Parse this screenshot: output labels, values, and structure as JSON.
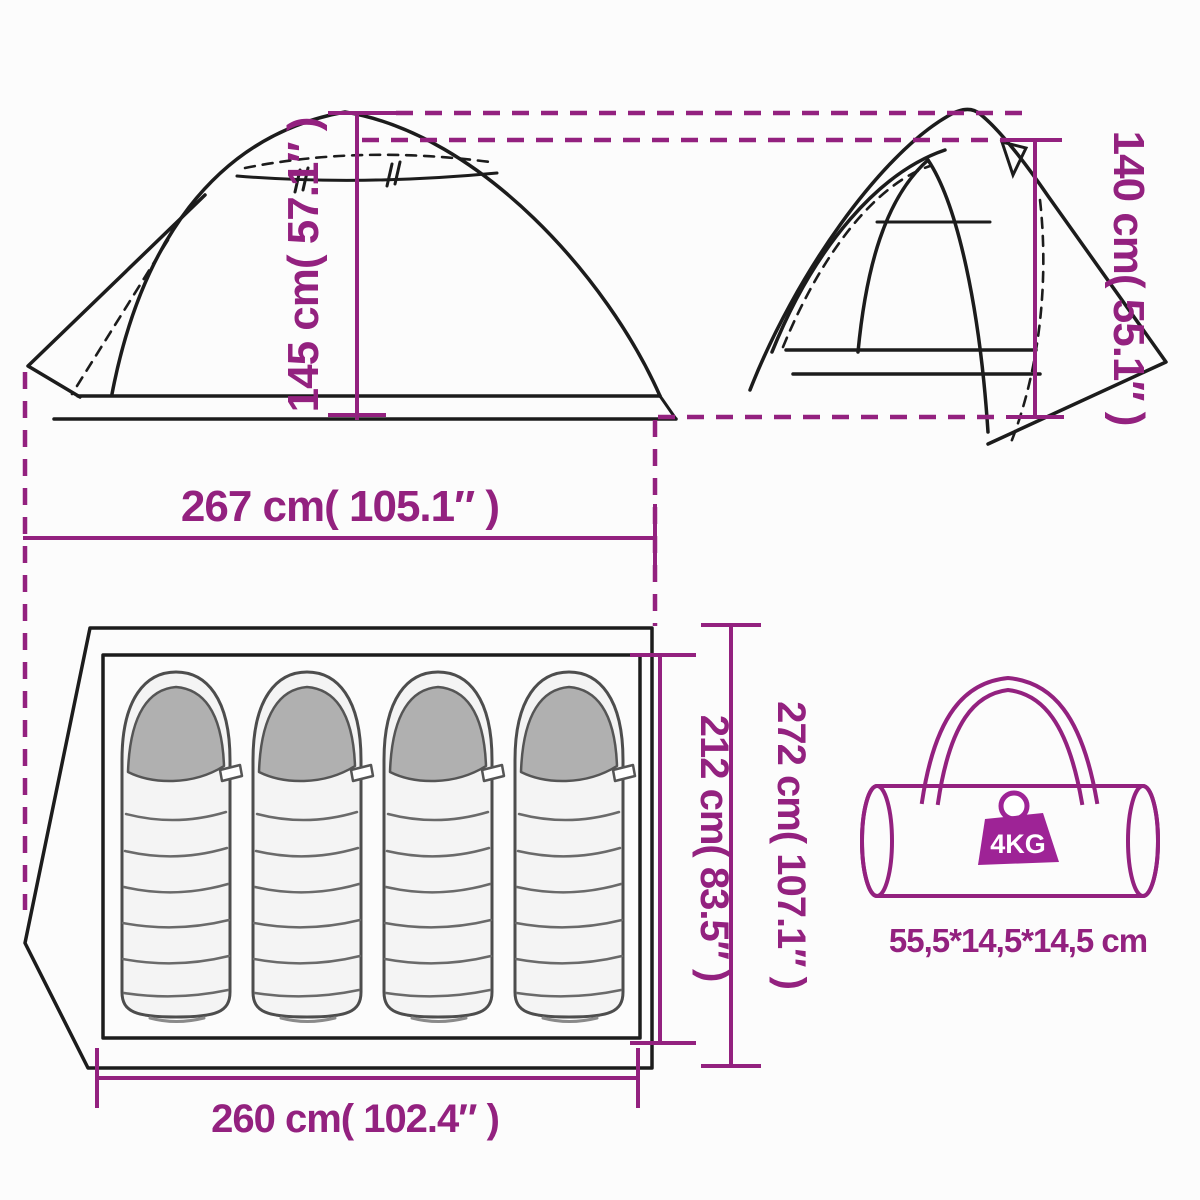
{
  "diagram": {
    "title": "tent-dimension-diagram",
    "accent_color": "#93217f",
    "line_color": "#1c1c1c",
    "side_view": {
      "height_label": "145 cm( 57.1″ )",
      "width_label": "267 cm( 105.1″ )"
    },
    "front_view": {
      "height_label": "140 cm( 55.1″ )"
    },
    "top_view": {
      "inner_length_label": "212 cm( 83.5″ )",
      "outer_length_label": "272 cm( 107.1″ )",
      "floor_width_label": "260 cm( 102.4″ )",
      "sleeping_bag_count": 4
    },
    "carry_bag": {
      "weight_label": "4KG",
      "size_label": "55,5*14,5*14,5 cm"
    }
  }
}
